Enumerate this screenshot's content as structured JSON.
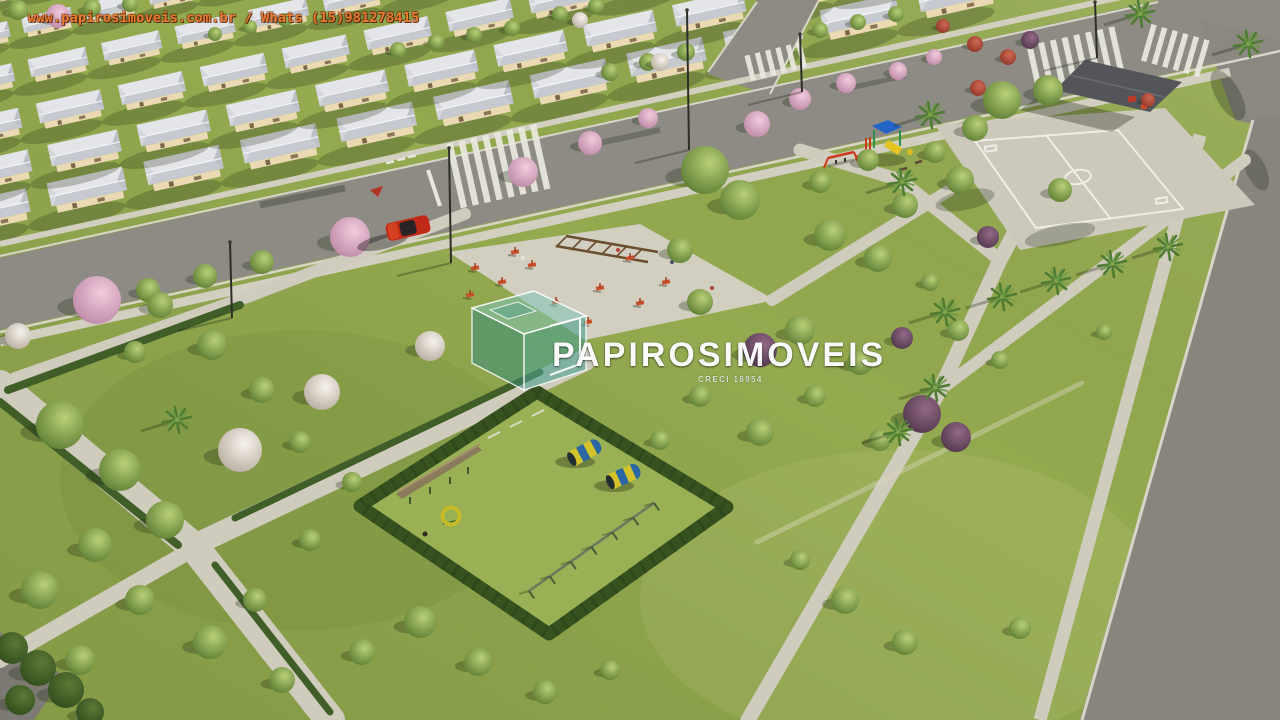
{
  "watermark": {
    "contact_line": "www.papirosimoveis.com.br / Whats (15)981278415",
    "brand": "PAPIROSIMOVEIS",
    "brand_sub": "CRECI 18954"
  },
  "colors": {
    "contact-text": "#ee7a2e",
    "brand-text": "#ffffff",
    "logo-teal": "#58a896",
    "grass": "#93aa4f",
    "grass-dark": "#6e8a3c",
    "asphalt": "#8d8b83",
    "concrete": "#cfcbbd",
    "roof-light": "#e4e5e9",
    "roof-dark": "#c7c9d0",
    "wall-cream": "#ead9b2",
    "hedge-green": "#3c5a26",
    "tree-pink": "#dcaac2",
    "tree-white": "#e9e4dc",
    "tree-purple": "#6e4c64",
    "barrel-blue": "#2a66a4",
    "barrel-yellow": "#d3c32b",
    "car-red": "#c22a18"
  },
  "scene": {
    "features": [
      "residential-houses",
      "streets-with-crosswalks",
      "central-park",
      "outdoor-gym-plaza",
      "playground",
      "multi-sport-court",
      "pavilion",
      "dog-park-agility-area",
      "palm-lined-paths",
      "avenue"
    ]
  }
}
